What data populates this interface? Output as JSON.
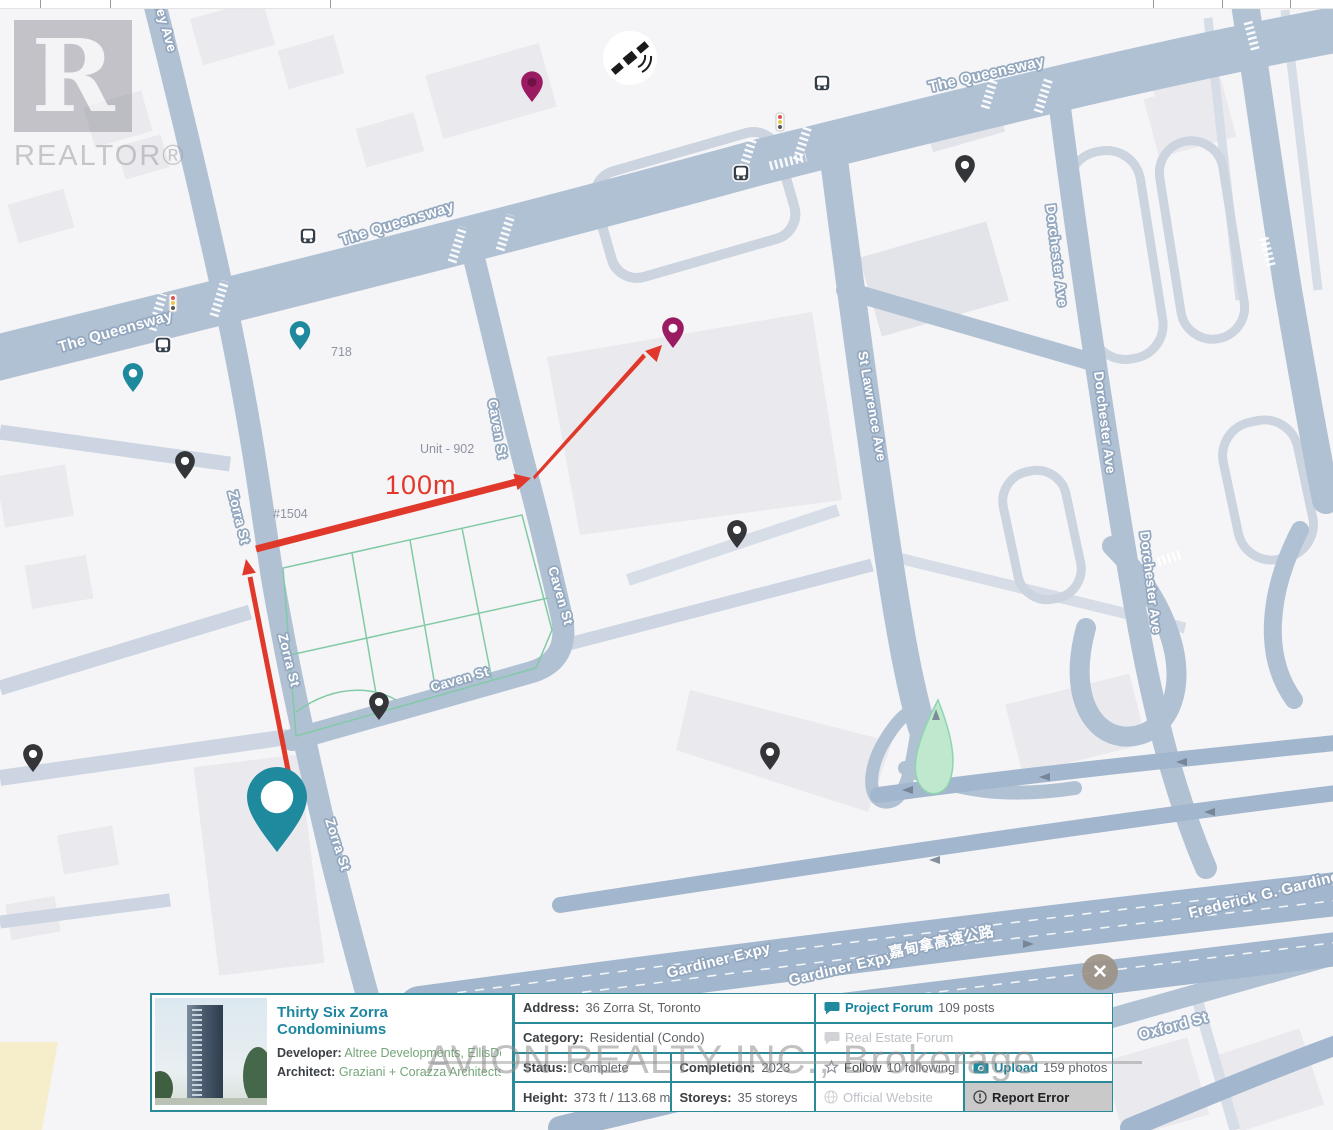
{
  "colors": {
    "pin_teal": "#1f8a9e",
    "pin_magenta": "#9b1b62",
    "pin_magenta_hole": "#701245",
    "pin_black": "#333538",
    "arrow_red": "#e0392b",
    "panel_teal": "#2b8a97",
    "link_green": "#74a578",
    "title_teal": "#1d87a0",
    "road": "#b1c1d4",
    "expressway": "#a2b6cd",
    "pond_green": "#bfe8cf"
  },
  "map": {
    "labels": {
      "queensway": "The Queensway",
      "wley_ave": "wley Ave",
      "zorra": "Zorra St",
      "caven": "Caven St",
      "st_lawrence": "St Lawrence Ave",
      "dorchester": "Dorchester Ave",
      "oxford": "Oxford St",
      "gardiner": "Gardiner Expy",
      "gardiner_cn": "嘉甸拿高速公路",
      "frederick": "Frederick G. Gardiner",
      "lot_718": "718",
      "unit_902": "Unit - 902",
      "lot_1504": "#1504",
      "distance": "100m"
    }
  },
  "watermarks": {
    "realtor_letter": "R",
    "realtor_text": "REALTOR®",
    "brokerage": "AVION REALTY INC., Brokerage"
  },
  "close_button": "✕",
  "panel": {
    "title": "Thirty Six Zorra Condominiums",
    "developer_label": "Developer:",
    "developer_value": "Altree Developments, EllisDon ...",
    "architect_label": "Architect:",
    "architect_value": "Graziani + Corazza Architects",
    "address_label": "Address:",
    "address_value": "36 Zorra St, Toronto",
    "category_label": "Category:",
    "category_value": "Residential (Condo)",
    "status_label": "Status:",
    "status_value": "Complete",
    "completion_label": "Completion:",
    "completion_value": "2023",
    "height_label": "Height:",
    "height_value": "373 ft / 113.68 m",
    "storeys_label": "Storeys:",
    "storeys_value": "35 storeys",
    "project_forum_label": "Project Forum",
    "project_forum_count": "109 posts",
    "real_estate_forum_label": "Real Estate Forum",
    "follow_label": "Follow",
    "follow_count": "10 following",
    "upload_label": "Upload",
    "upload_count": "159 photos",
    "official_website_label": "Official Website",
    "report_error_label": "Report Error"
  }
}
